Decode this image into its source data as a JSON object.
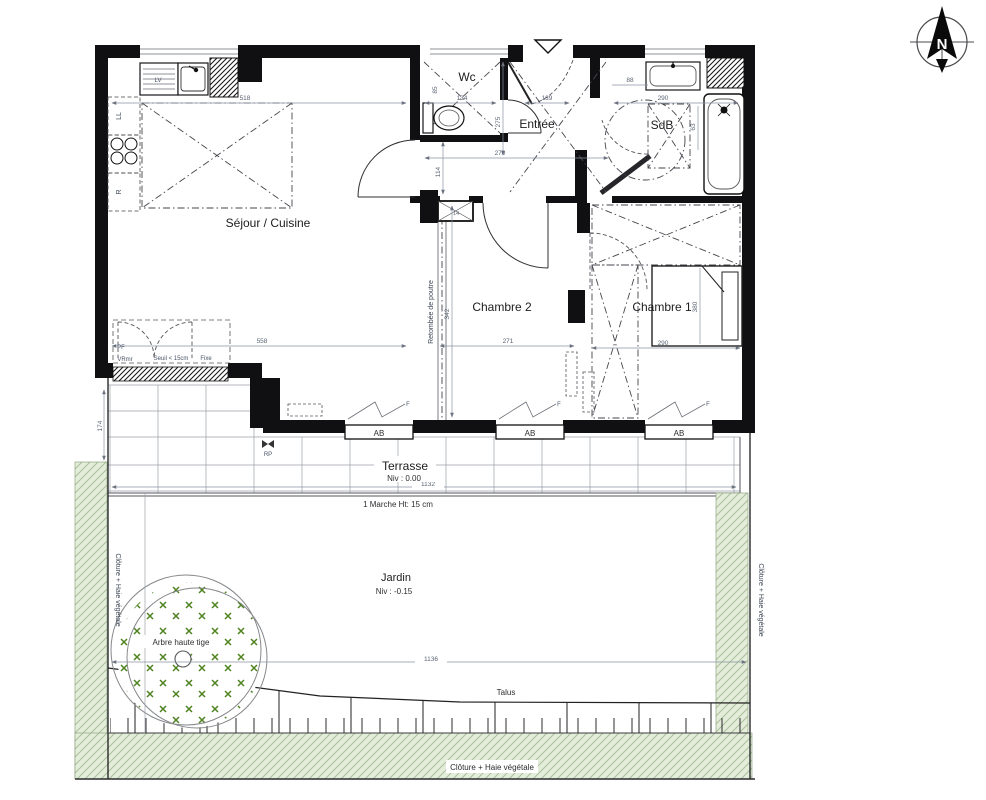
{
  "compass": {
    "north_letter": "N"
  },
  "rooms": {
    "sejour_cuisine": "Séjour / Cuisine",
    "wc": "Wc",
    "entree": "Entrée",
    "sdb": "SdB",
    "chambre2": "Chambre 2",
    "chambre1": "Chambre 1",
    "terrasse": "Terrasse",
    "terrasse_level": "Niv : 0.00",
    "jardin": "Jardin",
    "jardin_level": "Niv : -0.15"
  },
  "annotations": {
    "marche": "1 Marche Ht: 15 cm",
    "arbre": "Arbre haute tige",
    "talus": "Talus",
    "cloture_bottom": "Clôture + Haie végétale",
    "cloture_left": "Clôture + Haie végétale",
    "cloture_right": "Clôture + Haie végétale",
    "retombee": "Retombée de poutre",
    "pf": "PF",
    "vr": "VRmr",
    "seuil": "Seuil < 15cm",
    "fixe": "Fixe",
    "rp": "RP",
    "lv": "LV",
    "ll": "LL",
    "refrigerateur": "R",
    "ab": "AB",
    "f": "F"
  },
  "dimensions": {
    "sejour_top": "518",
    "sejour_bottom": "558",
    "wc_width": "134",
    "wc_side": "85",
    "wc_height": "114",
    "entree_width": "139",
    "entree_height": "275",
    "hall_width": "270",
    "sdb_width": "290",
    "sdb_door": "88",
    "sdb_side": "63",
    "window_int": "14",
    "chambre2_width": "271",
    "chambre2_height": "342",
    "chambre1_width": "290",
    "chambre1_height": "380",
    "terrasse_width": "1132",
    "terrasse_depth": "174",
    "jardin_width": "1136"
  },
  "colors": {
    "wall": "#101012",
    "hedge_fill": "#e4edda",
    "hedge_line": "#a9bf9a",
    "tree_marks": "#4e8320",
    "dim_text": "#5b6575"
  }
}
